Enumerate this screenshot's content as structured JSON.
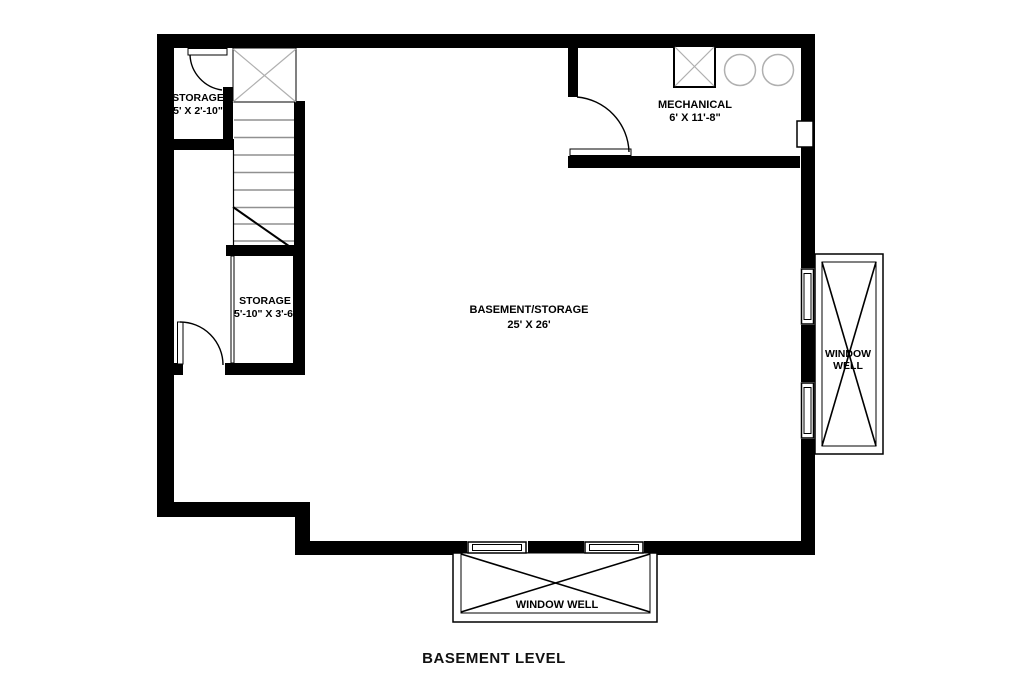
{
  "title": "BASEMENT LEVEL",
  "colors": {
    "wall": "#000000",
    "detail": "#b0b0b0",
    "tread": "#909090",
    "background": "#ffffff"
  },
  "rooms": {
    "storage1": {
      "name": "STORAGE",
      "dims": "5' X 2'-10\""
    },
    "storage2": {
      "name": "STORAGE",
      "dims": "5'-10\" X 3'-6\""
    },
    "mechanical": {
      "name": "MECHANICAL",
      "dims": "6' X 11'-8\""
    },
    "basement": {
      "name": "BASEMENT/STORAGE",
      "dims": "25' X 26'"
    }
  },
  "window_wells": {
    "right": {
      "line1": "WINDOW",
      "line2": "WELL"
    },
    "bottom": {
      "label": "WINDOW WELL"
    }
  }
}
